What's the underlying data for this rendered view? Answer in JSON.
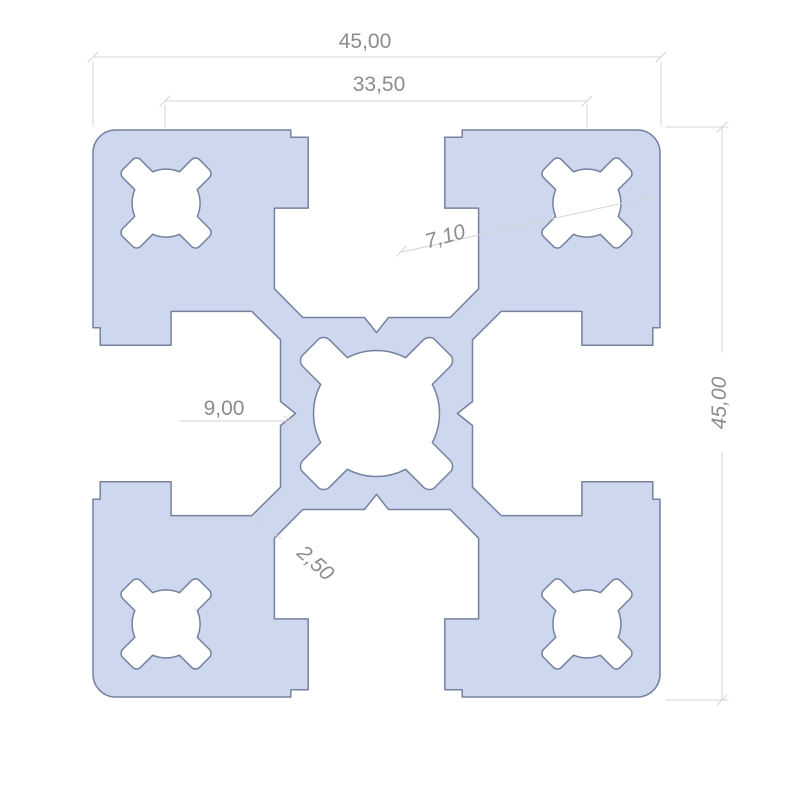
{
  "drawing": {
    "type": "technical-cross-section",
    "dims": {
      "overall_width": "45,00",
      "cavity_spacing": "33,50",
      "slot_detail": "7,10",
      "core_detail": "9,00",
      "web_thickness": "2,50",
      "overall_height": "45,00"
    },
    "colors": {
      "profile_fill": "#cdd8ef",
      "profile_stroke": "#75819f",
      "dim_line": "#d4d4d4",
      "dim_text": "#8c8c8c",
      "background": "#ffffff"
    }
  }
}
